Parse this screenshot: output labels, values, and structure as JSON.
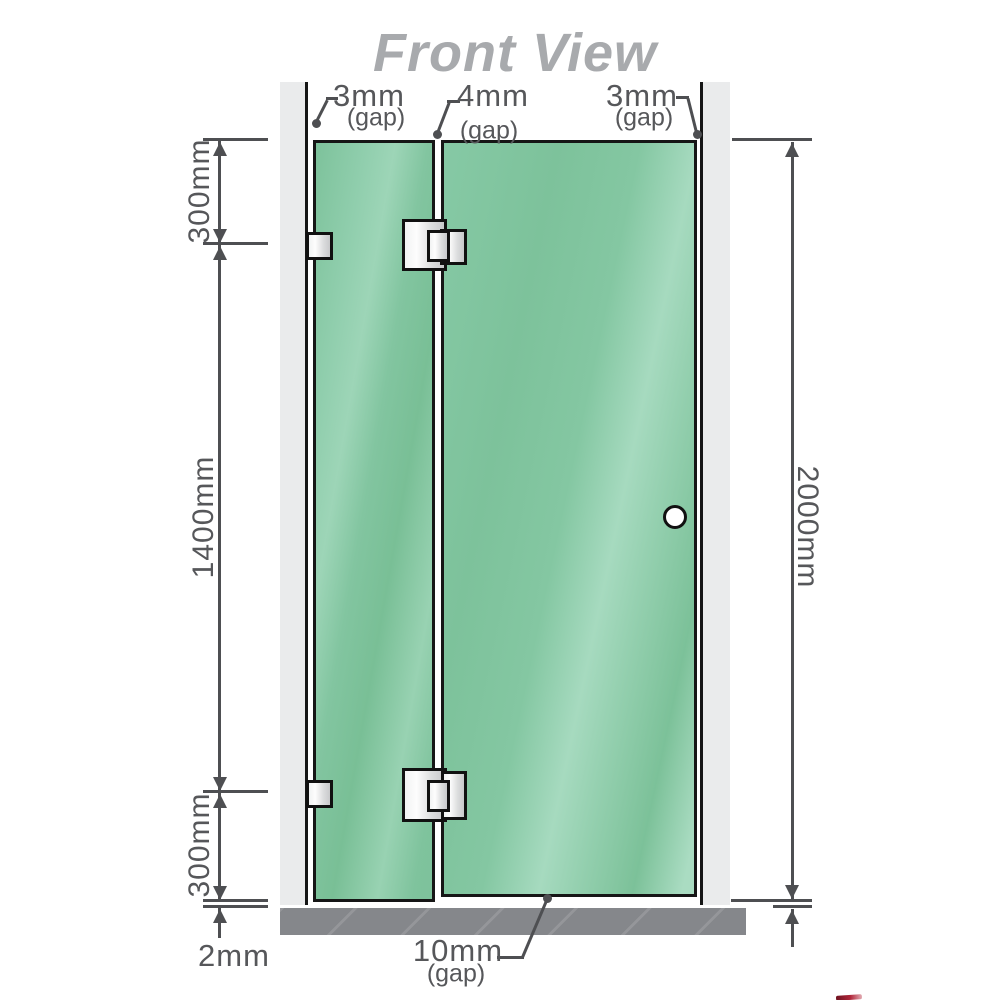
{
  "title": "Front View",
  "annotations": {
    "gap_top_left": {
      "value": "3mm",
      "qualifier": "(gap)"
    },
    "gap_top_middle": {
      "value": "4mm",
      "qualifier": "(gap)"
    },
    "gap_top_right": {
      "value": "3mm",
      "qualifier": "(gap)"
    },
    "gap_bottom": {
      "value": "10mm",
      "qualifier": "(gap)"
    },
    "floor_clearance": "2mm"
  },
  "measurements": {
    "left_top_section": "300mm",
    "left_middle_section": "1400mm",
    "left_bottom_section": "300mm",
    "right_full_height": "2000mm"
  },
  "colors": {
    "glass": "#80c49d",
    "glass_highlight": "#a6dabf",
    "wall_channel": "#eaebec",
    "floor": "#85878b",
    "dimension_lines": "#4e4f52",
    "label_text": "#56575a",
    "title_text": "#a8aaad",
    "hardware": "#e8e9ea",
    "outline": "#161616"
  }
}
